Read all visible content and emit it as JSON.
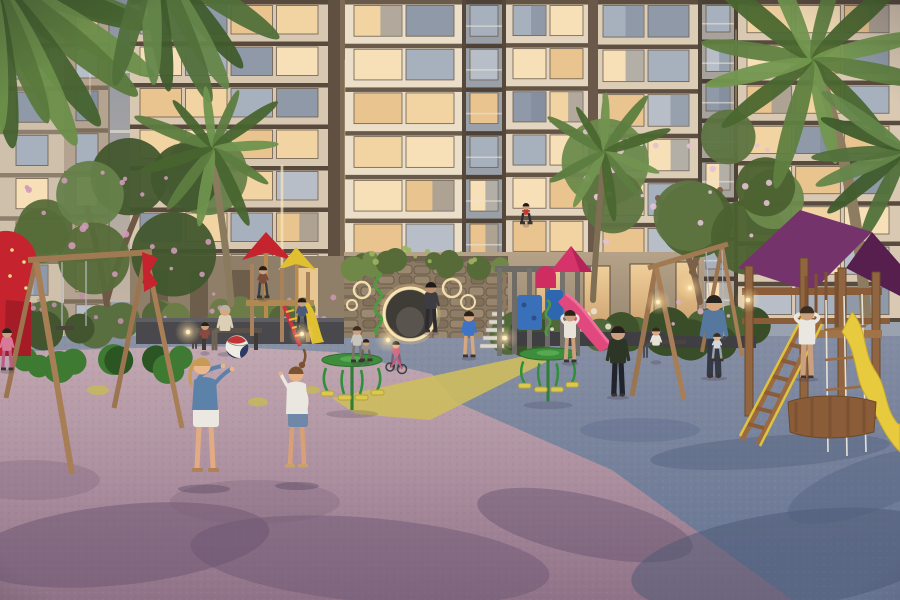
{
  "scene": {
    "label": "residential-courtyard-playground-render-dusk",
    "palette": {
      "sky": "#9aa2b0",
      "facade_cream": "#e9dcc6",
      "slab_brown": "#57493c",
      "window_warm": [
        "#f2d3a2",
        "#f7e0b8",
        "#e9c48e"
      ],
      "window_dusk": [
        "#a7b0bd",
        "#8f99a8",
        "#b7bec8"
      ],
      "ground_pink": "#b79cab",
      "ground_blue": "#76839d",
      "path_yellow": "#cdbd5e",
      "equip_red": "#c5242e",
      "equip_yellow": "#e2c235",
      "equip_green": "#2f8f3a",
      "canopy_purple": "#6b2b60",
      "slide_pink": "#e0487e",
      "wood": "#91653f",
      "stone": "#8b7963",
      "foliage": "#55663a",
      "blossom_pink": "#cf9ab6",
      "led_warm": "#f6e4b4"
    },
    "ground": {
      "pinkPath": "M0,352 L210,346 L336,352 L432,374 L456,402 L612,470 L792,600 L0,600 Z",
      "yellowPath": "M332,398 L520,357 L556,357 L430,420 L356,414 Z",
      "yellowPatches": [
        [
          98,
          390,
          11,
          5
        ],
        [
          258,
          402,
          10,
          4.5
        ],
        [
          312,
          390,
          8,
          4
        ]
      ]
    },
    "buildings": [
      {
        "name": "bldg-left-wall",
        "x": 0,
        "y": 0,
        "w": 64,
        "h": 346,
        "facade": "#cfc0ac",
        "slab": "#8d7f6d",
        "floors": 8,
        "cols": 1,
        "pad": 14,
        "warm": 0.25
      },
      {
        "name": "bldg-left-recessed",
        "x": 64,
        "y": 0,
        "w": 46,
        "h": 342,
        "facade": "#b4a390",
        "slab": "#7e6f5d",
        "floors": 8,
        "cols": 1,
        "pad": 10,
        "warm": 0.45
      },
      {
        "name": "bldg-mid-left",
        "x": 130,
        "y": 0,
        "w": 198,
        "h": 332,
        "facade": "#d8c8b2",
        "slab": "#57493c",
        "floors": 8,
        "cols": 4,
        "pad": 8,
        "warm": 0.6
      },
      {
        "name": "bldg-center-tower",
        "x": 344,
        "y": 0,
        "w": 120,
        "h": 306,
        "facade": "#ecdfc9",
        "slab": "#6a5a49",
        "floors": 7,
        "cols": 2,
        "pad": 8,
        "warm": 0.75
      },
      {
        "name": "bldg-center-balconies",
        "x": 464,
        "y": 0,
        "w": 40,
        "h": 306,
        "facade": "#9aa0a8",
        "slab": "#4e4236",
        "floors": 7,
        "cols": 1,
        "pad": 4,
        "warm": 0.35,
        "rail": true
      },
      {
        "name": "bldg-center-right",
        "x": 504,
        "y": 0,
        "w": 88,
        "h": 302,
        "facade": "#e3d5bf",
        "slab": "#635444",
        "floors": 7,
        "cols": 2,
        "pad": 7,
        "warm": 0.7
      },
      {
        "name": "bldg-right-a",
        "x": 592,
        "y": 0,
        "w": 108,
        "h": 312,
        "facade": "#dccdb7",
        "slab": "#5d4e41",
        "floors": 7,
        "cols": 2,
        "pad": 9,
        "warm": 0.6
      },
      {
        "name": "bldg-right-balconies",
        "x": 700,
        "y": 0,
        "w": 36,
        "h": 316,
        "facade": "#a7a39c",
        "slab": "#4a3f35",
        "floors": 8,
        "cols": 1,
        "pad": 4,
        "warm": 0.4,
        "rail": true
      },
      {
        "name": "bldg-right-b",
        "x": 736,
        "y": 0,
        "w": 164,
        "h": 322,
        "facade": "#d9c9b3",
        "slab": "#584a3d",
        "floors": 8,
        "cols": 3,
        "pad": 9,
        "warm": 0.65
      }
    ],
    "pilasters": [
      [
        328,
        0,
        16,
        312,
        "#5f5041"
      ],
      [
        340,
        0,
        5,
        306,
        "#7e6c57"
      ],
      [
        588,
        0,
        10,
        302,
        "#6a594a"
      ],
      [
        462,
        0,
        4,
        306,
        "#55483b"
      ],
      [
        502,
        0,
        4,
        302,
        "#55483b"
      ],
      [
        698,
        0,
        4,
        316,
        "#4e4337"
      ],
      [
        734,
        0,
        4,
        322,
        "#4e4337"
      ],
      [
        108,
        0,
        3,
        330,
        "#8d7f6d"
      ]
    ],
    "trees": [
      {
        "name": "tree-flowering-left",
        "cx": 120,
        "cy": 225,
        "spread": 95,
        "blobs": 8,
        "g": [
          "#42572e",
          "#566c39",
          "#66814a"
        ],
        "fl": "#cf9ab6",
        "flN": 20,
        "trunk": "M108,314 C103,272 95,240 87,208 M107,300 C117,262 128,236 137,214",
        "trunkW": 6,
        "trunkC": "#6e5846"
      },
      {
        "name": "tree-frangipani-right",
        "cx": 680,
        "cy": 185,
        "spread": 95,
        "blobs": 8,
        "g": [
          "#4b612f",
          "#5d7440",
          "#6d8a4c"
        ],
        "fl": "#e3c2d3",
        "flN": 26,
        "trunk": "M700,302 C694,262 678,228 658,198 M692,272 C702,240 714,214 720,190",
        "trunkW": 6,
        "trunkC": "#7b604a"
      }
    ],
    "palms": [
      {
        "name": "palm-fronds-topleft",
        "cx": -10,
        "cy": -25,
        "n": 9,
        "len": 210,
        "a0": 12,
        "a1": 88,
        "colors": [
          "#5a7a3c",
          "#46632f",
          "#6c8f4a"
        ]
      },
      {
        "name": "palm-fronds-topleft-b",
        "cx": 150,
        "cy": -45,
        "n": 7,
        "len": 165,
        "a0": 35,
        "a1": 105,
        "colors": [
          "#51703a",
          "#3f5c2c",
          "#64864a"
        ]
      },
      {
        "name": "palm-mid-left",
        "cx": 213,
        "cy": 148,
        "n": 11,
        "len": 86,
        "a0": -160,
        "a1": 160,
        "colors": [
          "#5d7d40",
          "#48652f",
          "#6f934e"
        ],
        "trunk": "M212,152 C220,210 228,258 231,304",
        "trunkW": 7,
        "trunkC": "#8a7a5e"
      },
      {
        "name": "palm-center",
        "cx": 604,
        "cy": 152,
        "n": 10,
        "len": 72,
        "a0": -150,
        "a1": 150,
        "colors": [
          "#5d7d40",
          "#4a672f",
          "#71944f"
        ],
        "trunk": "M604,158 C599,210 595,258 593,300",
        "trunkW": 6,
        "trunkC": "#7d6e54"
      },
      {
        "name": "palm-right-large",
        "cx": 812,
        "cy": 60,
        "n": 12,
        "len": 140,
        "a0": -170,
        "a1": 170,
        "colors": [
          "#5f8040",
          "#4a672f",
          "#73974f"
        ],
        "trunk": "M818,70 C842,140 860,220 866,320",
        "trunkW": 11,
        "trunkC": "#8d7c60"
      },
      {
        "name": "palm-right-edge",
        "cx": 905,
        "cy": 150,
        "n": 6,
        "len": 110,
        "a0": 120,
        "a1": 220,
        "colors": [
          "#51703a",
          "#3f5c2c",
          "#64864a"
        ]
      }
    ],
    "hedges": [
      {
        "name": "hedge-left-edge",
        "x": 0,
        "y": 296,
        "w": 130,
        "h": 40,
        "c1": "#5a6f3f",
        "c2": "#43552e",
        "fl": "#bd8fa9",
        "flN": 8
      },
      {
        "name": "planter-flowers-left",
        "x": 136,
        "y": 294,
        "w": 208,
        "h": 34,
        "c1": "#6c7c46",
        "c2": "#55663a",
        "fl": "#c897b4",
        "flN": 14
      },
      {
        "name": "wall-top-greens",
        "x": 346,
        "y": 248,
        "w": 164,
        "h": 24,
        "c1": "#6f8747",
        "c2": "#566b37",
        "fl": "#9fb45e",
        "flN": 10
      },
      {
        "name": "hedge-right-of-wall",
        "x": 508,
        "y": 304,
        "w": 156,
        "h": 40,
        "c1": "#51683a",
        "c2": "#3e522c",
        "fl": "#e8e3d2",
        "flN": 8
      },
      {
        "name": "hedge-far-right",
        "x": 664,
        "y": 298,
        "w": 92,
        "h": 50,
        "c1": "#4c6336",
        "c2": "#3a4d29",
        "fl": "#d9afc4",
        "flN": 6
      },
      {
        "name": "bush-left-a",
        "x": 18,
        "y": 342,
        "w": 58,
        "h": 34,
        "c1": "#3f7a33",
        "c2": "#2e5a26",
        "fl": "",
        "flN": 0
      },
      {
        "name": "bush-left-b",
        "x": 108,
        "y": 344,
        "w": 84,
        "h": 30,
        "c1": "#3f7a33",
        "c2": "#2c5524",
        "fl": "",
        "flN": 0
      }
    ],
    "shadows": [
      [
        120,
        545,
        150,
        40,
        -6,
        "#6b5470",
        0.5
      ],
      [
        370,
        560,
        180,
        42,
        5,
        "#6b5470",
        0.45
      ],
      [
        585,
        525,
        110,
        30,
        12,
        "#5d4b68",
        0.4
      ],
      [
        255,
        502,
        85,
        22,
        0,
        "#7a5f78",
        0.3
      ],
      [
        30,
        480,
        70,
        20,
        0,
        "#7a5f78",
        0.3
      ],
      [
        790,
        560,
        160,
        48,
        -8,
        "#4c5874",
        0.5
      ],
      [
        868,
        486,
        85,
        26,
        -20,
        "#51607e",
        0.4
      ],
      [
        770,
        452,
        120,
        16,
        -4,
        "#55617e",
        0.45
      ],
      [
        640,
        430,
        60,
        12,
        0,
        "#5a688a",
        0.35
      ]
    ],
    "lights": [
      [
        302,
        334
      ],
      [
        388,
        340
      ],
      [
        188,
        332
      ],
      [
        658,
        302
      ],
      [
        690,
        288
      ],
      [
        748,
        300
      ],
      [
        505,
        338
      ]
    ],
    "people": [
      {
        "name": "person-boy-dark",
        "x": 618,
        "y": 326,
        "h": 70,
        "shirt": "#2c3526",
        "pants": "#22242b",
        "hair": "#241d18",
        "skin": "#caa07e"
      },
      {
        "name": "person-boy-blue",
        "x": 469,
        "y": 311,
        "h": 46,
        "shirt": "#3f74c4",
        "pants": "#2e3440",
        "hair": "#2a211b",
        "skin": "#d7a87f",
        "skinLegs": true
      },
      {
        "name": "person-kid-white",
        "x": 570,
        "y": 310,
        "h": 52,
        "shirt": "#e8e4da",
        "pants": "#565b61",
        "hair": "#2a211b",
        "skin": "#caa07e",
        "skinLegs": true,
        "armsUp": true
      },
      {
        "name": "person-father",
        "x": 714,
        "y": 295,
        "h": 82,
        "shirt": "#56789f",
        "pants": "#343946",
        "hair": "#2a241e",
        "skin": "#d7a87f"
      },
      {
        "name": "person-swing-child",
        "x": 717,
        "y": 333,
        "h": 28,
        "shirt": "#d3d6dc",
        "pants": "#9aa0a8",
        "hair": "#3a2d22",
        "skin": "#e0b48c"
      },
      {
        "name": "person-sitting-man",
        "x": 656,
        "y": 327,
        "h": 34,
        "sit": true,
        "dir": -1,
        "shirt": "#e7e3d9",
        "pants": "#4a4f57",
        "hair": "#33291f",
        "skin": "#d7a87f"
      },
      {
        "name": "person-woman-white",
        "x": 807,
        "y": 306,
        "h": 72,
        "shirt": "#eae7e0",
        "pants": "#caa07e",
        "hair": "#3a2d22",
        "skin": "#caa07e",
        "armsUp": true,
        "skinLegs": true
      },
      {
        "name": "person-bench-man",
        "x": 225,
        "y": 305,
        "h": 48,
        "sit": true,
        "dir": -1,
        "shirt": "#dbcfb6",
        "pants": "#6e6256",
        "hair": "#b9b2a6",
        "skin": "#d7a87f"
      },
      {
        "name": "person-bench-kid",
        "x": 205,
        "y": 322,
        "h": 30,
        "sit": true,
        "dir": -1,
        "shirt": "#8a4a42",
        "pants": "#4e4540",
        "hair": "#2a211b",
        "skin": "#caa07e"
      },
      {
        "name": "person-mom",
        "x": 357,
        "y": 326,
        "h": 36,
        "shirt": "#c9c4bc",
        "pants": "#7b756d",
        "hair": "#3a2d22",
        "skin": "#caa07e"
      },
      {
        "name": "person-small-child",
        "x": 366,
        "y": 339,
        "h": 22,
        "shirt": "#9a8f85",
        "pants": "#6b635c",
        "hair": "#2a211b",
        "skin": "#caa07e"
      },
      {
        "name": "person-woman-pink",
        "x": 7,
        "y": 328,
        "h": 42,
        "shirt": "#d8799a",
        "pants": "#b75f84",
        "hair": "#2a211b",
        "skin": "#caa07e"
      },
      {
        "name": "person-on-balcony",
        "x": 526,
        "y": 203,
        "h": 21,
        "shirt": "#c03a30",
        "pants": "#2e2e34",
        "hair": "#1f1a16",
        "skin": "#caa07e"
      },
      {
        "name": "person-gate-walker",
        "x": 431,
        "y": 282,
        "h": 50,
        "shirt": "#3c3c42",
        "pants": "#2b2b31",
        "hair": "#1f1a16",
        "skin": "#b98f6e"
      },
      {
        "name": "person-pagoda-kid",
        "x": 263,
        "y": 266,
        "h": 32,
        "shirt": "#7a4a3a",
        "pants": "#3c3c44",
        "hair": "#241d18",
        "skin": "#caa07e"
      },
      {
        "name": "person-climber-kid",
        "x": 302,
        "y": 298,
        "h": 34,
        "shirt": "#4a5a7a",
        "pants": "#33383f",
        "hair": "#241d18",
        "skin": "#caa07e"
      },
      {
        "name": "person-toddler",
        "x": 396,
        "y": 341,
        "h": 26,
        "shirt": "#d86a84",
        "pants": "#7f5f74",
        "hair": "#2a211b",
        "skin": "#e0b48c"
      }
    ]
  }
}
